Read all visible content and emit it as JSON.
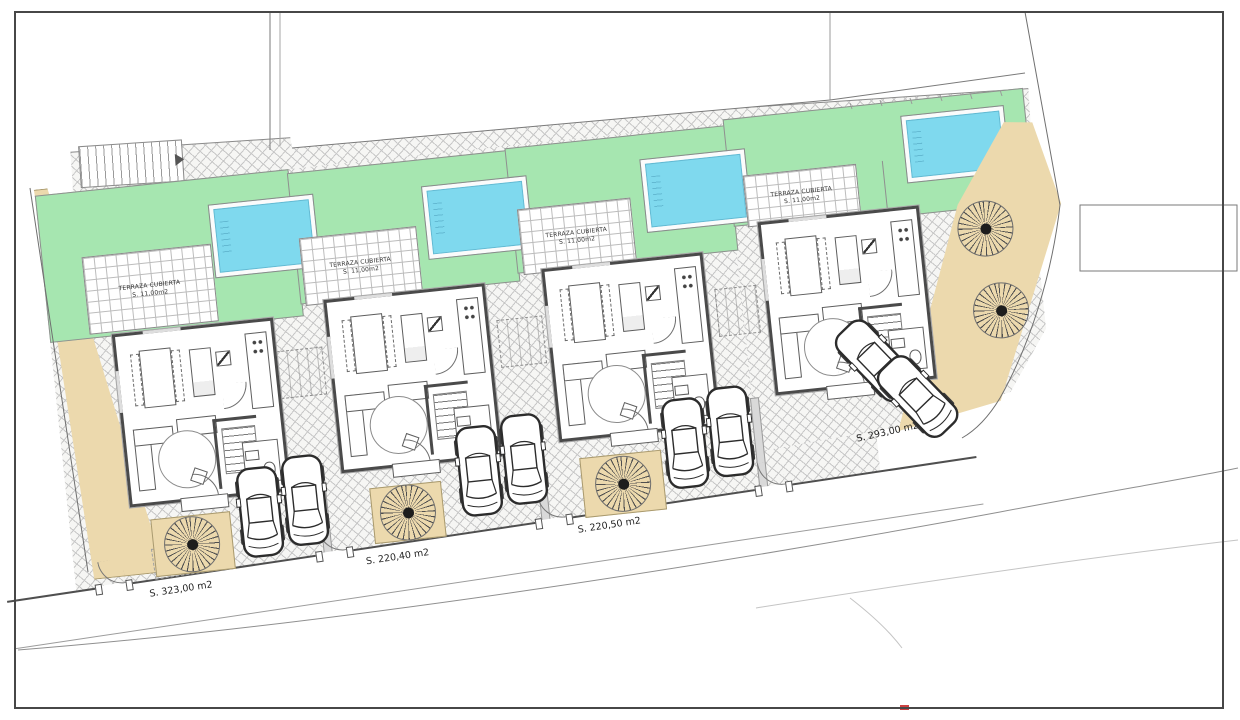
{
  "plan": {
    "type": "residential site plan, 4 detached villas",
    "villas": [
      {
        "terrace_label": "TERRAZA CUBIERTA",
        "terrace_area": "S. 11,00m2",
        "plot_area": "S. 323,00 m2"
      },
      {
        "terrace_label": "TERRAZA CUBIERTA",
        "terrace_area": "S. 11,00m2",
        "plot_area": "S. 220,40 m2"
      },
      {
        "terrace_label": "TERRAZA CUBIERTA",
        "terrace_area": "S. 11,00m2",
        "plot_area": "S. 220,50 m2"
      },
      {
        "terrace_label": "TERRAZA CUBIERTA",
        "terrace_area": "S. 11,00m2",
        "plot_area": "S. 293,00 m2"
      }
    ],
    "icons": {
      "tree": "tree-icon: circular starburst canopy with dark center",
      "car": "car-icon: automobile top view",
      "ramp_arrow": "arrow-right-icon"
    },
    "colors": {
      "garden_green": "#a6e6b0",
      "pool_blue": "#7fd9ee",
      "sand_tan": "#ecd9ad",
      "wall_dark": "#4a4a4a"
    }
  }
}
